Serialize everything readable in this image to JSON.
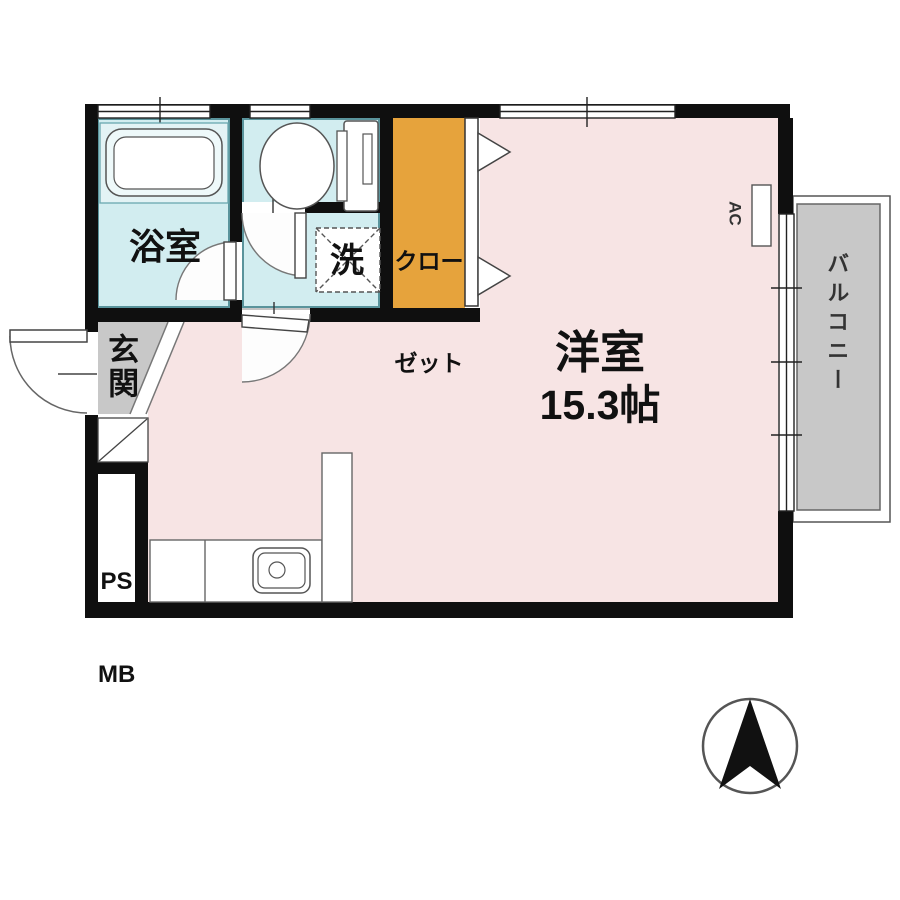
{
  "floor_plan": {
    "main_room": {
      "name": "洋室",
      "area": "15.3帖"
    },
    "bathroom": {
      "name": "浴室"
    },
    "laundry_space": {
      "name": "洗"
    },
    "closet": {
      "name_line1": "クロー",
      "name_line2": "ゼット"
    },
    "entrance": {
      "name": "玄関"
    },
    "balcony": {
      "name": "バルコニー"
    },
    "utility_shaft": {
      "line1": "PS",
      "line2": "MB"
    },
    "air_conditioner": {
      "label": "AC"
    },
    "compass": {
      "meaning": "north-arrow"
    },
    "colors": {
      "main_room_fill": "#f7e4e4",
      "wet_area_fill": "#d2edf0",
      "closet_fill": "#e6a33c",
      "balcony_fill": "#c8c8c8",
      "entrance_fill": "#c8c8c8",
      "wall": "#0f0f0f"
    }
  }
}
